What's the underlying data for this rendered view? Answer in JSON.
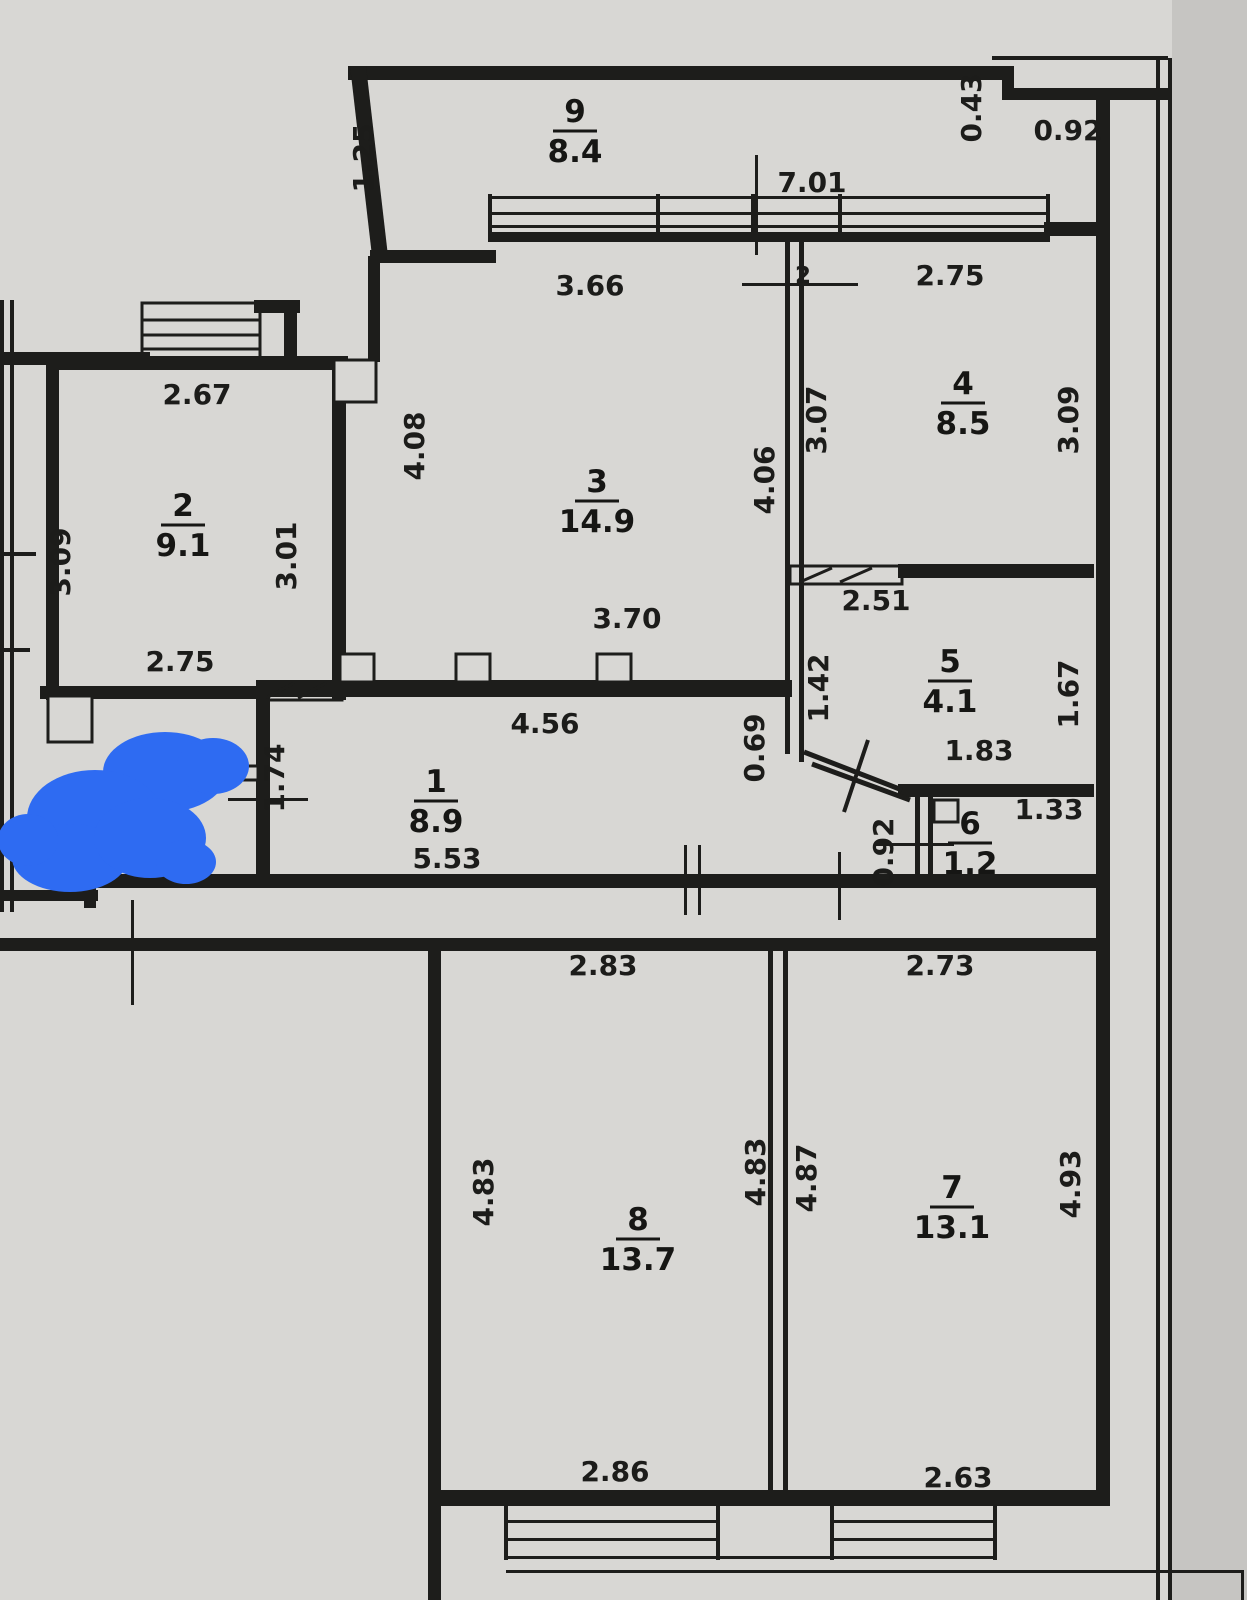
{
  "plan": {
    "kind": "apartment-floor-plan",
    "rooms": [
      {
        "id": "room-1",
        "number": "1",
        "area": "8.9",
        "x": 436,
        "y": 792
      },
      {
        "id": "room-2",
        "number": "2",
        "area": "9.1",
        "x": 183,
        "y": 516
      },
      {
        "id": "room-3",
        "number": "3",
        "area": "14.9",
        "x": 597,
        "y": 492
      },
      {
        "id": "room-4",
        "number": "4",
        "area": "8.5",
        "x": 963,
        "y": 394
      },
      {
        "id": "room-5",
        "number": "5",
        "area": "4.1",
        "x": 950,
        "y": 672
      },
      {
        "id": "room-6",
        "number": "6",
        "area": "1.2",
        "x": 970,
        "y": 834
      },
      {
        "id": "room-7",
        "number": "7",
        "area": "13.1",
        "x": 952,
        "y": 1198
      },
      {
        "id": "room-8",
        "number": "8",
        "area": "13.7",
        "x": 638,
        "y": 1230
      },
      {
        "id": "room-9",
        "number": "9",
        "area": "8.4",
        "x": 575,
        "y": 122
      }
    ],
    "dimensions": [
      {
        "value": "1.25",
        "x": 373,
        "y": 158,
        "vertical": true
      },
      {
        "value": "0.43",
        "x": 981,
        "y": 108,
        "vertical": true
      },
      {
        "value": "0.92",
        "x": 1068,
        "y": 140
      },
      {
        "value": "7.01",
        "x": 812,
        "y": 192
      },
      {
        "value": "3.66",
        "x": 590,
        "y": 295
      },
      {
        "value": "2.75",
        "x": 950,
        "y": 285
      },
      {
        "value": "2",
        "x": 803,
        "y": 283,
        "size": 23
      },
      {
        "value": "2.67",
        "x": 197,
        "y": 404
      },
      {
        "value": "4.08",
        "x": 424,
        "y": 446,
        "vertical": true
      },
      {
        "value": "3.07",
        "x": 826,
        "y": 420,
        "vertical": true
      },
      {
        "value": "4.06",
        "x": 774,
        "y": 480,
        "vertical": true
      },
      {
        "value": "3.09",
        "x": 1078,
        "y": 420,
        "vertical": true
      },
      {
        "value": "3.09",
        "x": 70,
        "y": 562,
        "vertical": true
      },
      {
        "value": "3.01",
        "x": 296,
        "y": 556,
        "vertical": true
      },
      {
        "value": "2.75",
        "x": 180,
        "y": 671
      },
      {
        "value": "2.51",
        "x": 876,
        "y": 610
      },
      {
        "value": "3.70",
        "x": 627,
        "y": 628
      },
      {
        "value": "1.42",
        "x": 828,
        "y": 688,
        "vertical": true
      },
      {
        "value": "1.67",
        "x": 1078,
        "y": 694,
        "vertical": true
      },
      {
        "value": "0.69",
        "x": 764,
        "y": 748,
        "vertical": true
      },
      {
        "value": "1.83",
        "x": 979,
        "y": 760
      },
      {
        "value": "4.56",
        "x": 545,
        "y": 733
      },
      {
        "value": "1.74",
        "x": 284,
        "y": 778,
        "vertical": true
      },
      {
        "value": "1.33",
        "x": 1049,
        "y": 819
      },
      {
        "value": "0.92",
        "x": 893,
        "y": 852,
        "vertical": true
      },
      {
        "value": "5.53",
        "x": 447,
        "y": 868
      },
      {
        "value": "2.83",
        "x": 603,
        "y": 975
      },
      {
        "value": "2.73",
        "x": 940,
        "y": 975
      },
      {
        "value": "4.83",
        "x": 493,
        "y": 1192,
        "vertical": true
      },
      {
        "value": "4.83",
        "x": 765,
        "y": 1172,
        "vertical": true
      },
      {
        "value": "4.87",
        "x": 816,
        "y": 1178,
        "vertical": true
      },
      {
        "value": "4.93",
        "x": 1080,
        "y": 1184,
        "vertical": true
      },
      {
        "value": "2.86",
        "x": 615,
        "y": 1481
      },
      {
        "value": "2.63",
        "x": 958,
        "y": 1487
      }
    ],
    "annotation": {
      "type": "marker-scribble",
      "color": "#2e6bf2"
    },
    "palette": {
      "paper": "#d8d7d4",
      "line": "#1d1d1b",
      "margin": "#c6c5c2"
    }
  }
}
